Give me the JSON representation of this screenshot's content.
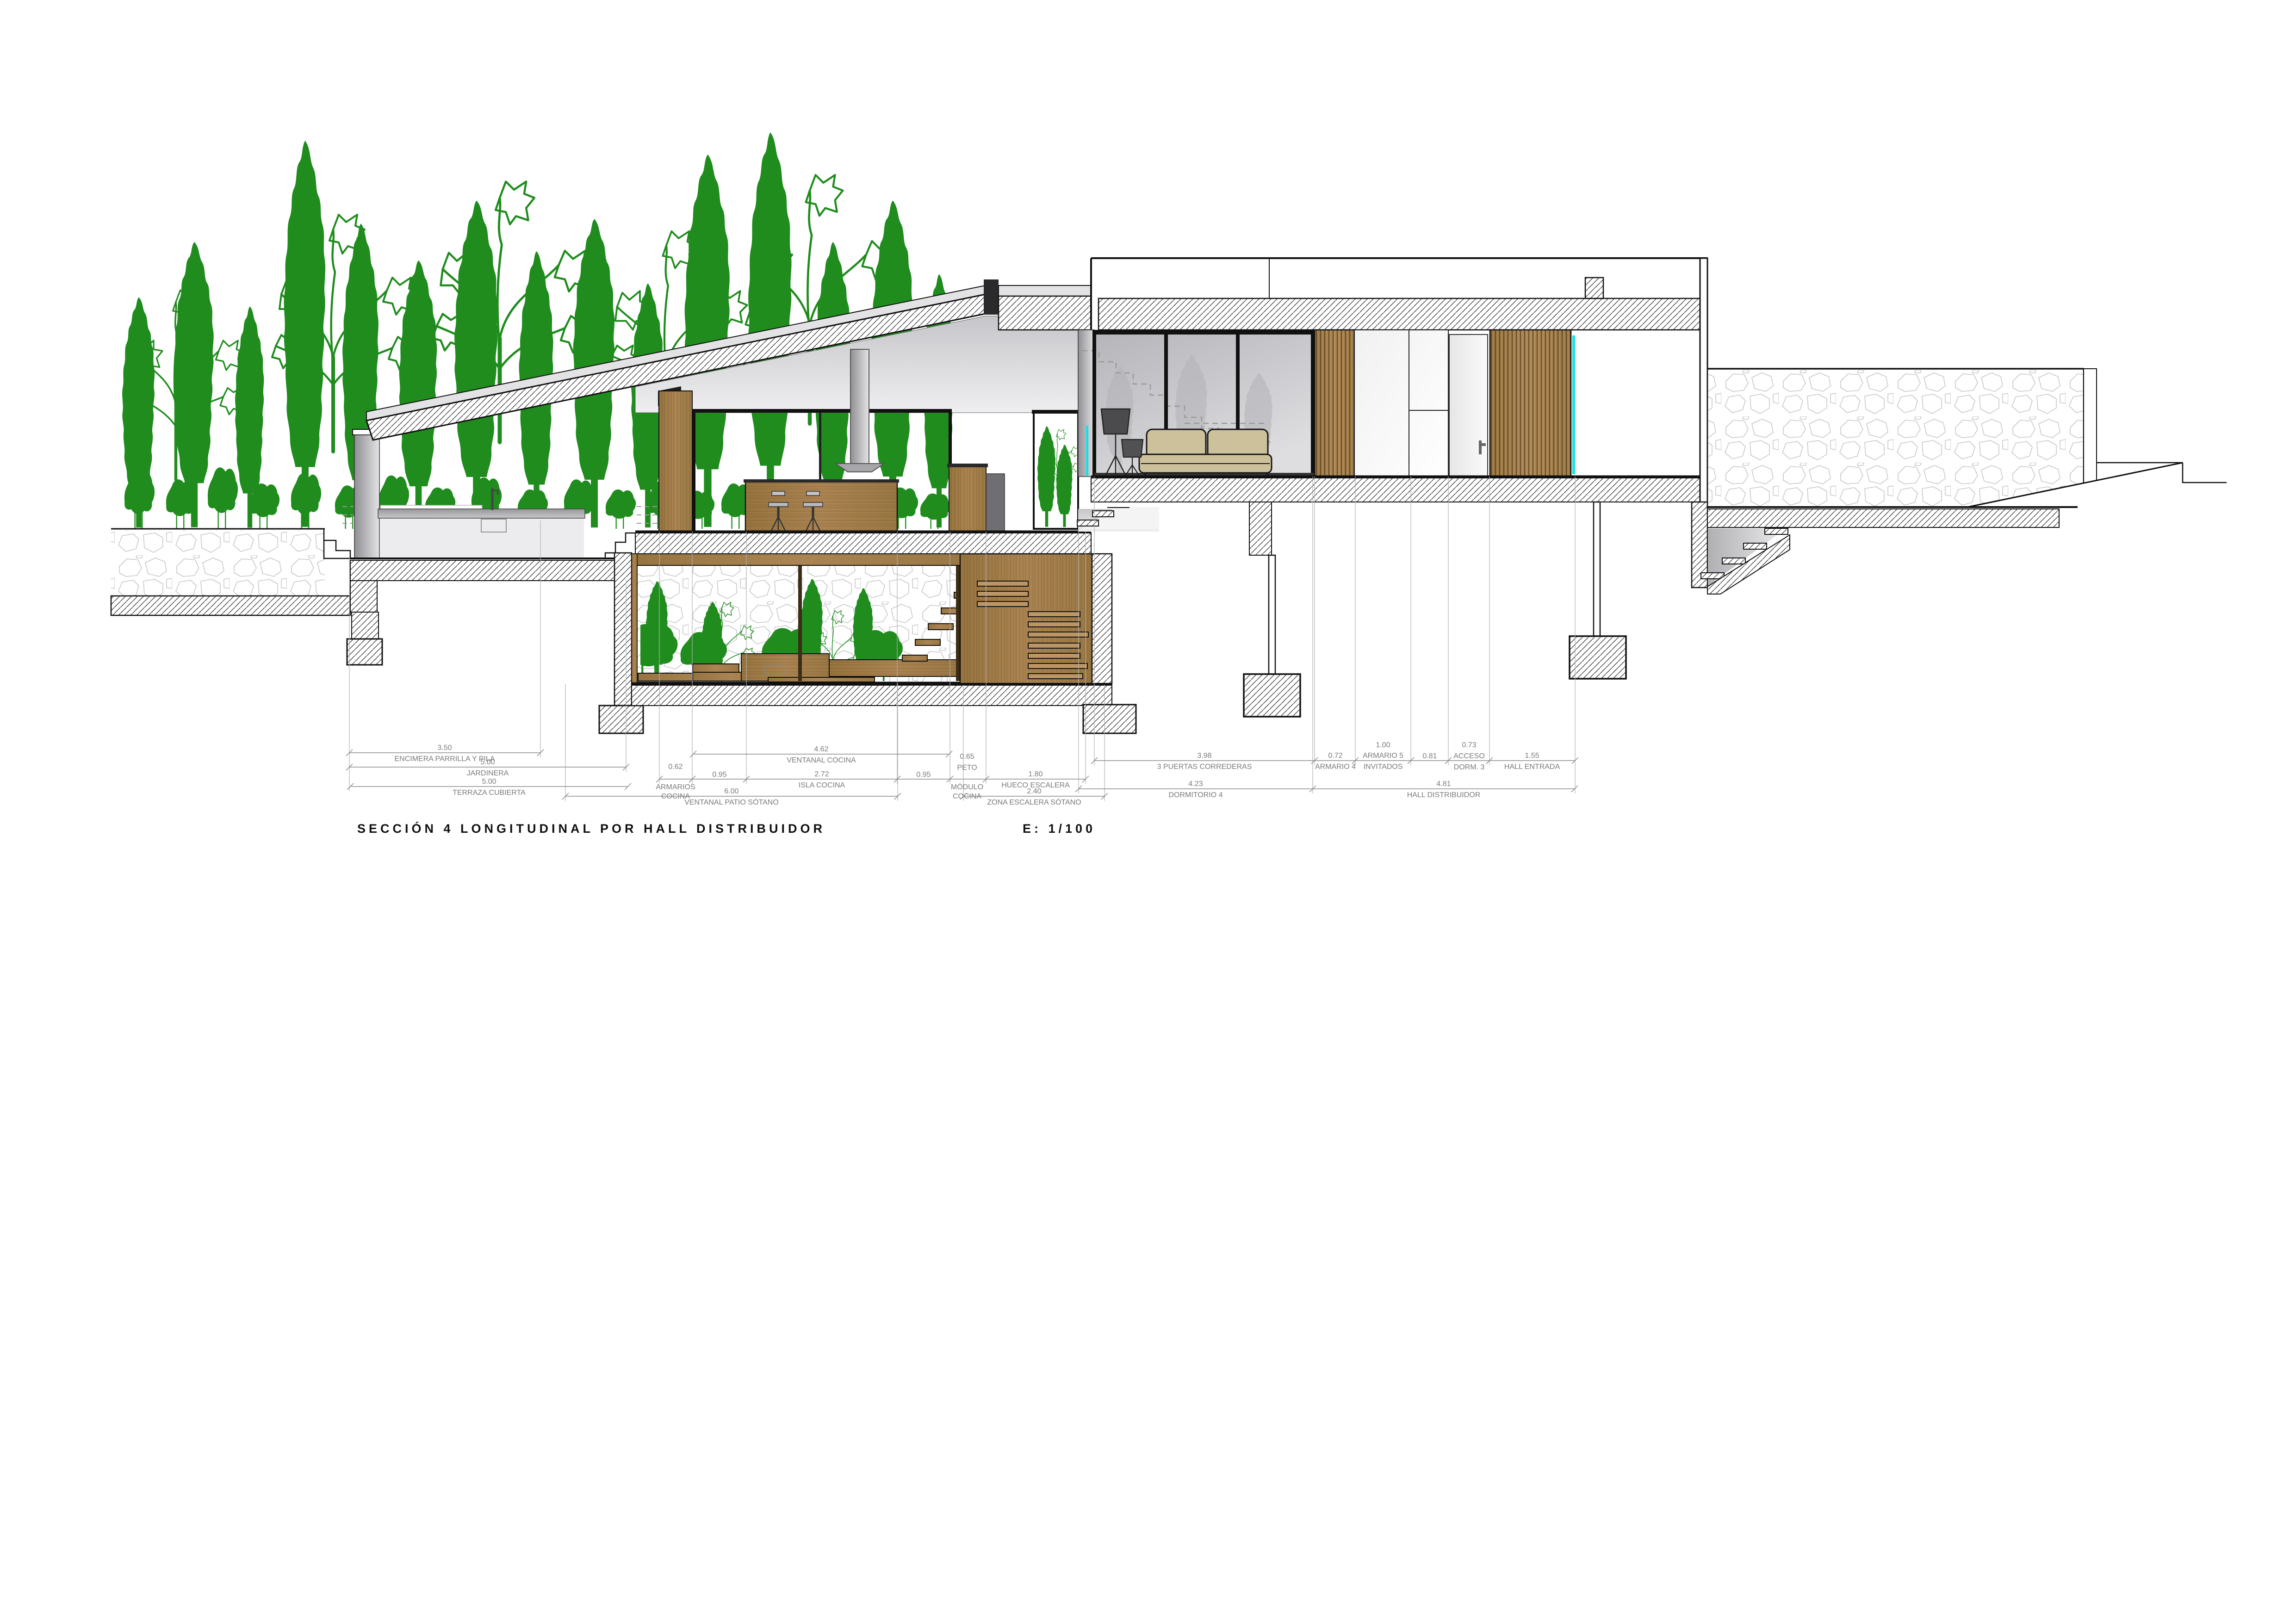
{
  "title": {
    "text": "SECCIÓN 4 LONGITUDINAL POR HALL DISTRIBUIDOR",
    "scale": "E: 1/100"
  },
  "colors": {
    "tree_green": "#1f8c1d",
    "wood": "#a07c4c",
    "wood_slat": "#bb9563",
    "accent_cyan": "#17e0e6",
    "sofa_beige": "#cdc19b",
    "dim_grey": "#7a7a7a",
    "line_black": "#111111"
  },
  "dims": {
    "left": [
      {
        "v": "3.50",
        "l": "ENCIMERA PARRILLA Y PILA"
      },
      {
        "v": "5.00",
        "l": "JARDINERA"
      },
      {
        "v": "5.00",
        "l": "TERRAZA CUBIERTA"
      }
    ],
    "mid": [
      {
        "v": "4.62",
        "l": "VENTANAL COCINA"
      },
      {
        "v": "0.62",
        "l": "ARMARIOS",
        "l2": "COCINA"
      },
      {
        "v": "0.95"
      },
      {
        "v": "2.72",
        "l": "ISLA COCINA"
      },
      {
        "v": "0.95"
      },
      {
        "v": "0.65",
        "l": "PETO",
        "l2": "MÓDULO",
        "l3": "COCINA"
      },
      {
        "v": "1.80",
        "l": "HUECO ESCALERA"
      },
      {
        "v": "6.00",
        "l": "VENTANAL PATIO SÓTANO"
      },
      {
        "v": "2.40",
        "l": "ZONA ESCALERA SÓTANO"
      }
    ],
    "right": [
      {
        "v": "3.98",
        "l": "3 PUERTAS CORREDERAS"
      },
      {
        "v": "0.72",
        "l": "ARMARIO 4"
      },
      {
        "v": "1.00",
        "l": "ARMARIO 5",
        "l2": "INVITADOS"
      },
      {
        "v": "0.81"
      },
      {
        "v": "0.73",
        "l": "ACCESO",
        "l2": "DORM. 3"
      },
      {
        "v": "1.55",
        "l": "HALL ENTRADA"
      },
      {
        "v": "4.23",
        "l": "DORMITORIO 4"
      },
      {
        "v": "4.81",
        "l": "HALL DISTRIBUIDOR"
      }
    ]
  }
}
